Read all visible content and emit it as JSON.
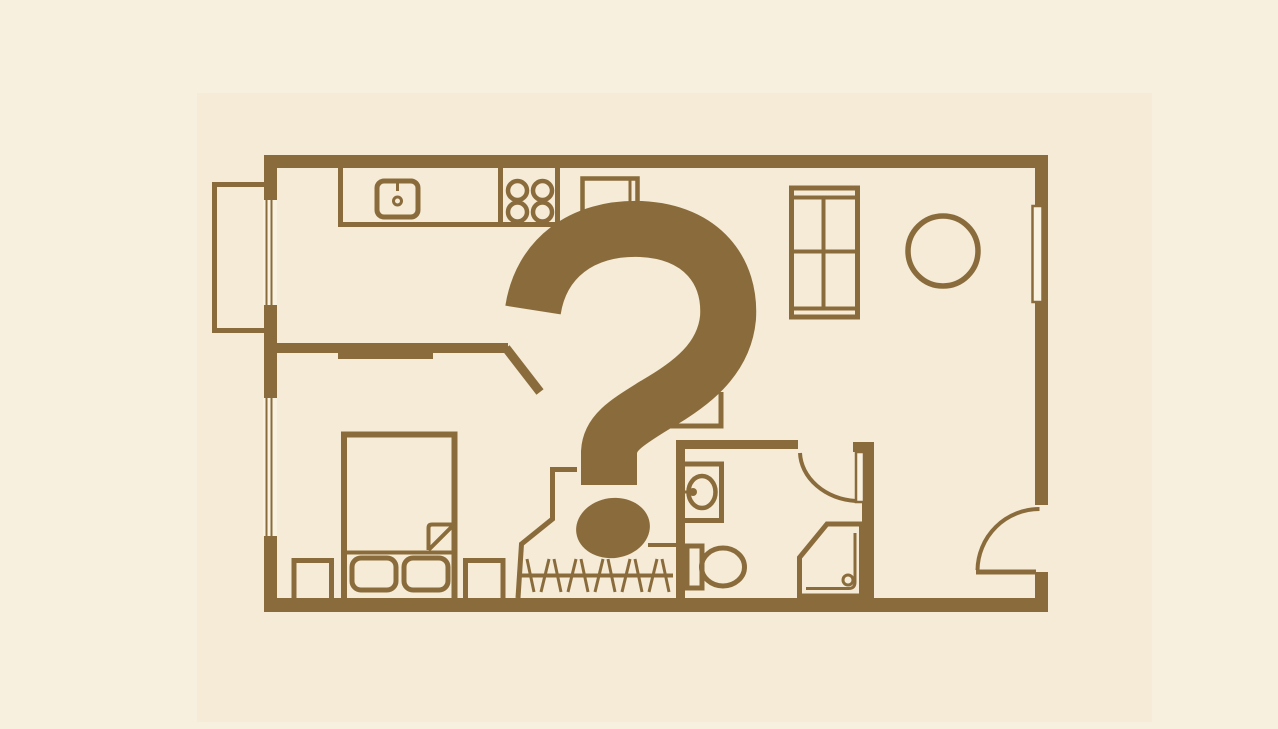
{
  "canvas": {
    "width": 1278,
    "height": 729
  },
  "colors": {
    "page_bg": "#f8f0de",
    "card_bg": "#f5ebd6",
    "ink": "#8a6c3c",
    "paper": "#f9f2e1"
  },
  "overlay": {
    "symbol": "?"
  },
  "icons": {
    "question_mark": "question-mark-overlay",
    "fixtures": [
      "balcony",
      "window",
      "kitchen-sink",
      "stove-burners",
      "refrigerator",
      "sofa",
      "round-table",
      "bed",
      "pillow",
      "nightstand",
      "hanger-rail",
      "bathroom-sink",
      "toilet",
      "shower",
      "door-swing"
    ]
  }
}
